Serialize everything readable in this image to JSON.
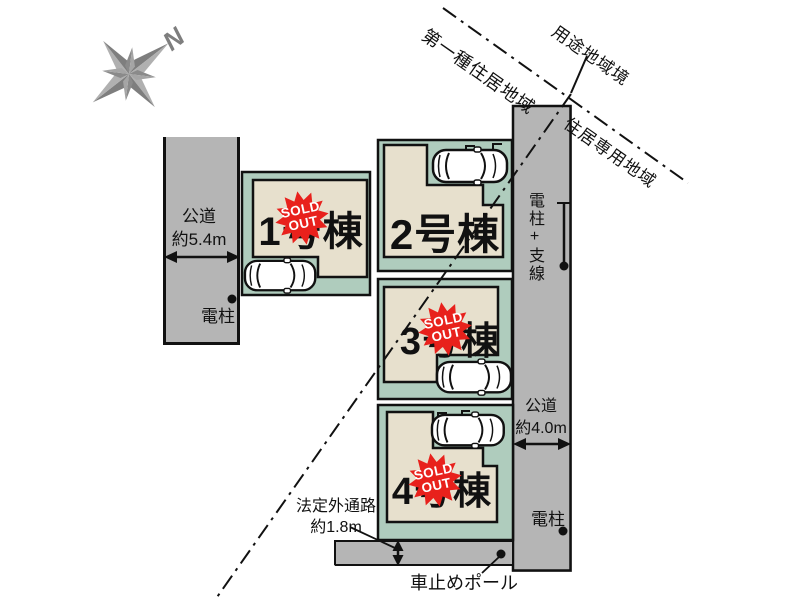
{
  "compass": {
    "north_label": "N"
  },
  "zoning": {
    "boundary_label": "用途地域境",
    "district_upper_left": "第一種住居地域",
    "district_lower_right": "住居専用地域"
  },
  "roads": {
    "left": {
      "name": "公道",
      "width": "約5.4m"
    },
    "right": {
      "name": "公道",
      "width": "約4.0m"
    },
    "rear_path": {
      "name": "法定外通路",
      "width": "約1.8m"
    }
  },
  "features": {
    "pole_left": "電柱",
    "pole_right": "電柱+支線",
    "pole_bottom": "電柱",
    "car_stop_pole": "車止めポール"
  },
  "lots": [
    {
      "label": "1号棟",
      "sold_out": true
    },
    {
      "label": "2号棟",
      "sold_out": false
    },
    {
      "label": "3号棟",
      "sold_out": true
    },
    {
      "label": "4号棟",
      "sold_out": true
    }
  ],
  "badge": {
    "line1": "SOLD",
    "line2": "OUT"
  },
  "colors": {
    "lot_green": "#afccbd",
    "building_beige": "#e7e0cd",
    "road_gray": "#b5b5b5",
    "sold_red": "#e8211c",
    "compass_gray": "#8a8a8a",
    "outline_black": "#111111"
  }
}
